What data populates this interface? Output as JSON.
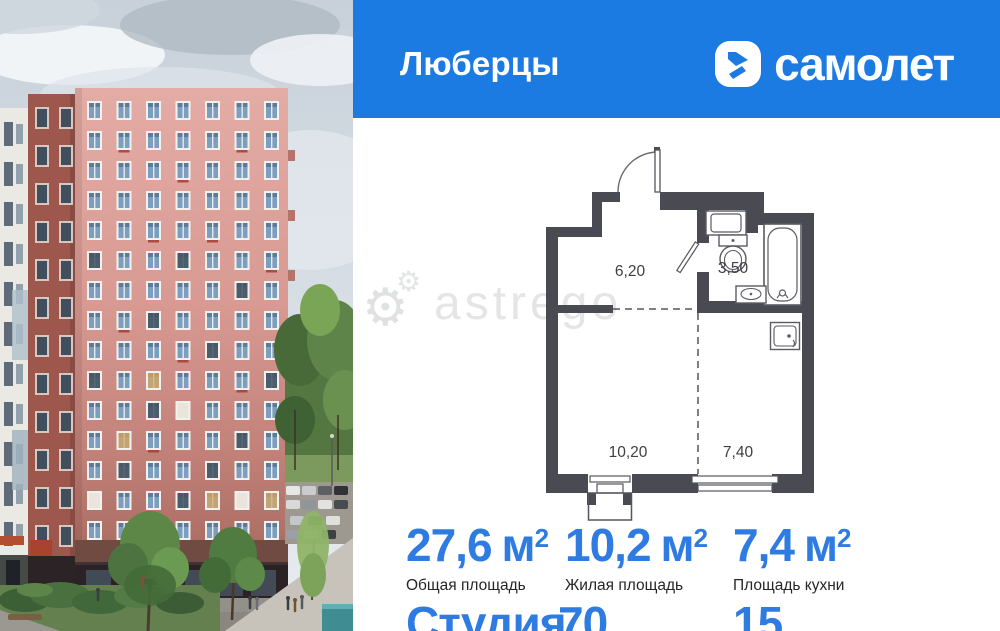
{
  "header": {
    "title": "Люберцы",
    "brand": "самолет"
  },
  "watermark": {
    "text": "astrego"
  },
  "floor_plan": {
    "rooms": [
      {
        "name": "hallway",
        "area": "6,20"
      },
      {
        "name": "bathroom",
        "area": "3,50"
      },
      {
        "name": "living-room",
        "area": "10,20"
      },
      {
        "name": "kitchen",
        "area": "7,40"
      }
    ]
  },
  "stats": [
    {
      "value": "27,6",
      "unit": "м",
      "unit_sup": "2",
      "label": "Общая площадь"
    },
    {
      "value": "10,2",
      "unit": "м",
      "unit_sup": "2",
      "label": "Жилая площадь"
    },
    {
      "value": "7,4",
      "unit": "м",
      "unit_sup": "2",
      "label": "Площадь кухни"
    }
  ],
  "bottom_row": [
    {
      "value": "Студия"
    },
    {
      "value": "70"
    },
    {
      "value": "15"
    }
  ],
  "colors": {
    "header_bg": "#1c7ae3",
    "accent_blue": "#2e7ce1",
    "plan_wall": "#4a4a52"
  }
}
